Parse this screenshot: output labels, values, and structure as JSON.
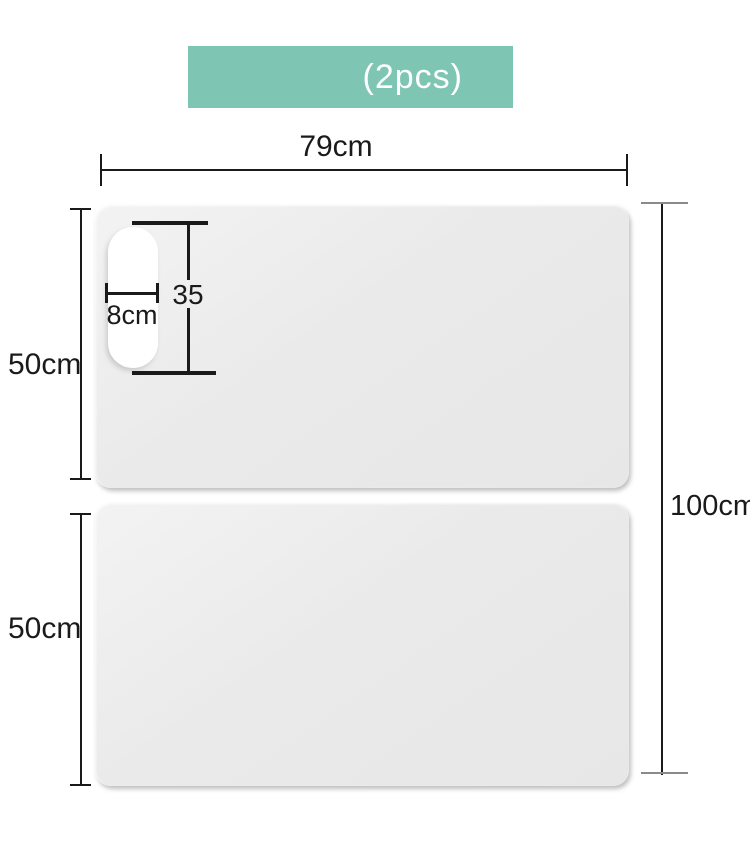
{
  "banner": {
    "label": "(2pcs)"
  },
  "colors": {
    "banner_bg": "#7ec6b3",
    "banner_text": "#ffffff",
    "panel_fill": "#e9e9e9",
    "hole_fill": "#ffffff",
    "dim_line": "#1a1a1a",
    "cap_gray": "#8a8a8a",
    "canvas_bg": "#ffffff"
  },
  "dimensions": {
    "board_width": "79cm",
    "total_height": "100cm",
    "top_panel_height": "50cm",
    "bottom_panel_height": "50cm",
    "hole_width": "8cm",
    "hole_height": "35"
  }
}
